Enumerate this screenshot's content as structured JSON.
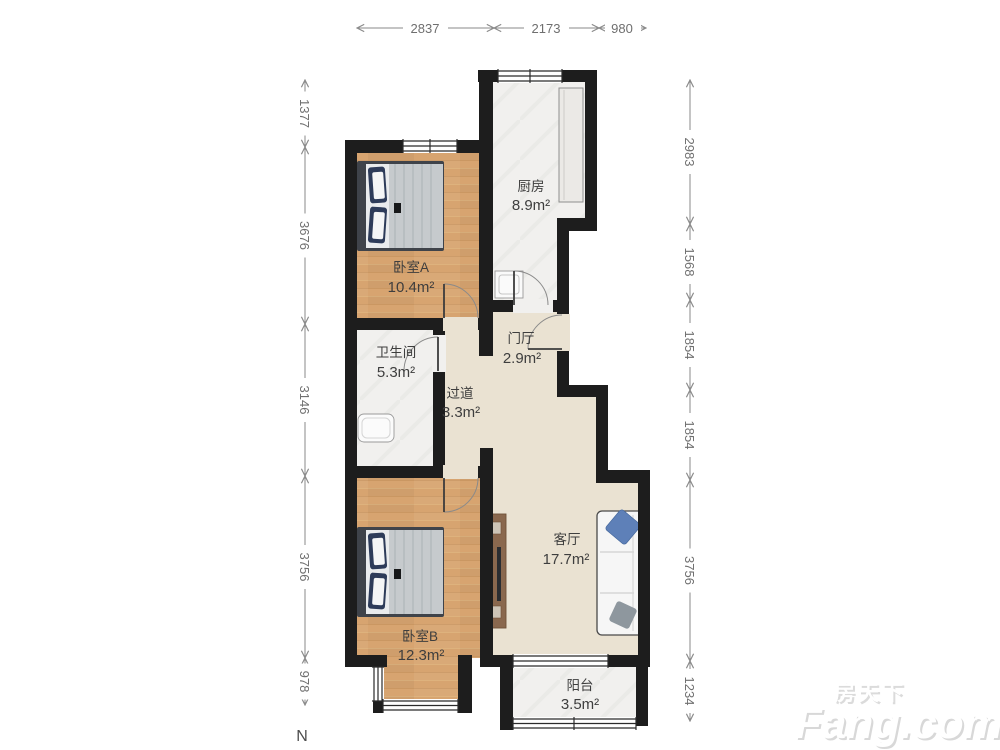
{
  "compass": {
    "north": "N"
  },
  "watermark": {
    "brand_cn": "房天下",
    "brand_en": "Fang.com"
  },
  "dimensions": {
    "top": [
      "2837",
      "2173",
      "980"
    ],
    "left": [
      "1377",
      "3676",
      "3146",
      "3756",
      "978"
    ],
    "right": [
      "2983",
      "1568",
      "1854",
      "1854",
      "3756",
      "1234"
    ]
  },
  "rooms": {
    "kitchen": {
      "name": "厨房",
      "area": "8.9m²"
    },
    "bedroomA": {
      "name": "卧室A",
      "area": "10.4m²"
    },
    "foyer": {
      "name": "门厅",
      "area": "2.9m²"
    },
    "bathroom": {
      "name": "卫生间",
      "area": "5.3m²"
    },
    "hallway": {
      "name": "过道",
      "area": "3.3m²"
    },
    "living": {
      "name": "客厅",
      "area": "17.7m²"
    },
    "bedroomB": {
      "name": "卧室B",
      "area": "12.3m²"
    },
    "balcony": {
      "name": "阳台",
      "area": "3.5m²"
    }
  },
  "colors": {
    "wall": "#1d1d1d",
    "wood_floor": "#d7a470",
    "tile_floor": "#f1f0ee",
    "warm_floor": "#eae2d2",
    "dimension_line": "#8a8a8a",
    "label_text": "#3e3e3e"
  }
}
